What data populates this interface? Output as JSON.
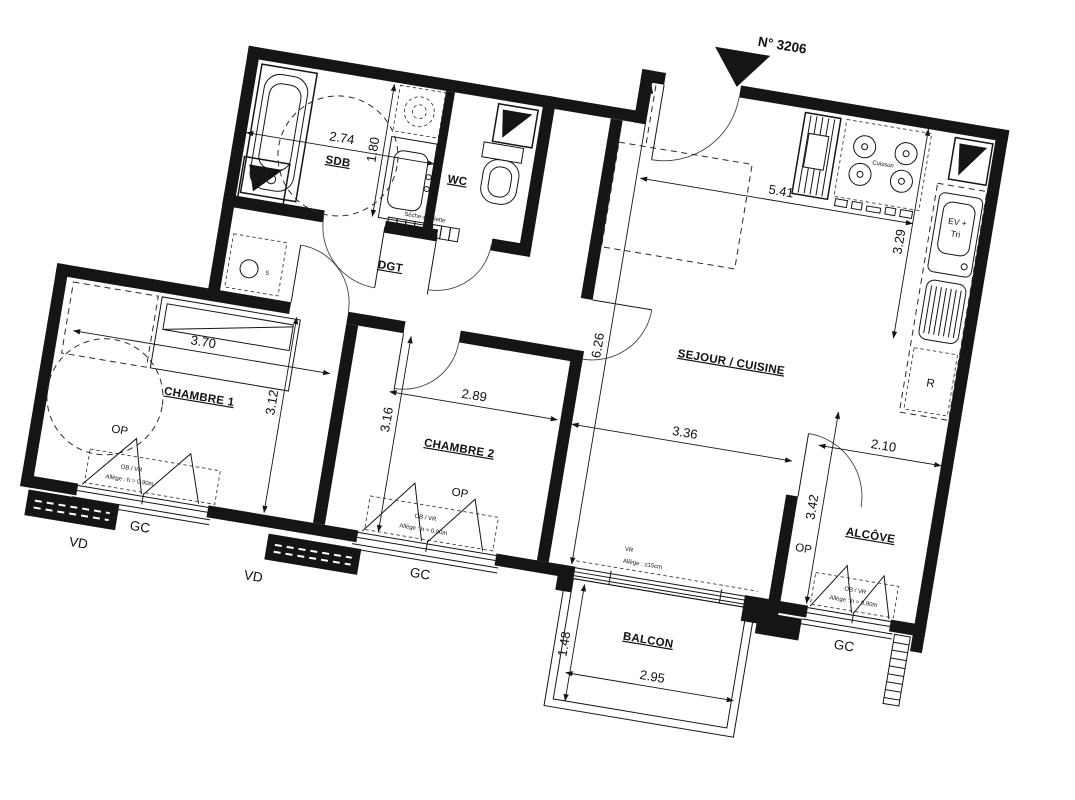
{
  "plan": {
    "unit_number": "N° 3206",
    "rooms": {
      "sdb": "SDB",
      "wc": "WC",
      "dgt": "DGT",
      "chambre1": "CHAMBRE 1",
      "chambre2": "CHAMBRE 2",
      "sejour": "SEJOUR / CUISINE",
      "alcove": "ALCÔVE",
      "balcon": "BALCON"
    },
    "dims": {
      "sdb_w": "2.74",
      "sdb_h": "1.80",
      "sejour_w": "5.41",
      "sejour_h": "6.26",
      "sejour_w2": "3.36",
      "kitchen_h": "3.29",
      "ch1_w": "3.70",
      "ch1_h": "3.12",
      "ch2_w": "2.89",
      "ch2_h": "3.16",
      "alcove_w": "2.10",
      "alcove_h": "3.42",
      "balcon_w": "2.95",
      "balcon_d": "1.48"
    },
    "annotations": {
      "op": "OP",
      "gc": "GC",
      "vd": "VD",
      "ob_vr": "OB / VR",
      "allege_fenetre": "Allège : h = 0,90m",
      "vr": "VR",
      "allege_baie": "Allège : ≤15cm",
      "seche_serviette": "Sèche-serviette",
      "cuisson": "Cuisson",
      "evier": "EV +",
      "tri": "Tri",
      "refrigerateur": "R",
      "washer_mark": "5"
    }
  }
}
